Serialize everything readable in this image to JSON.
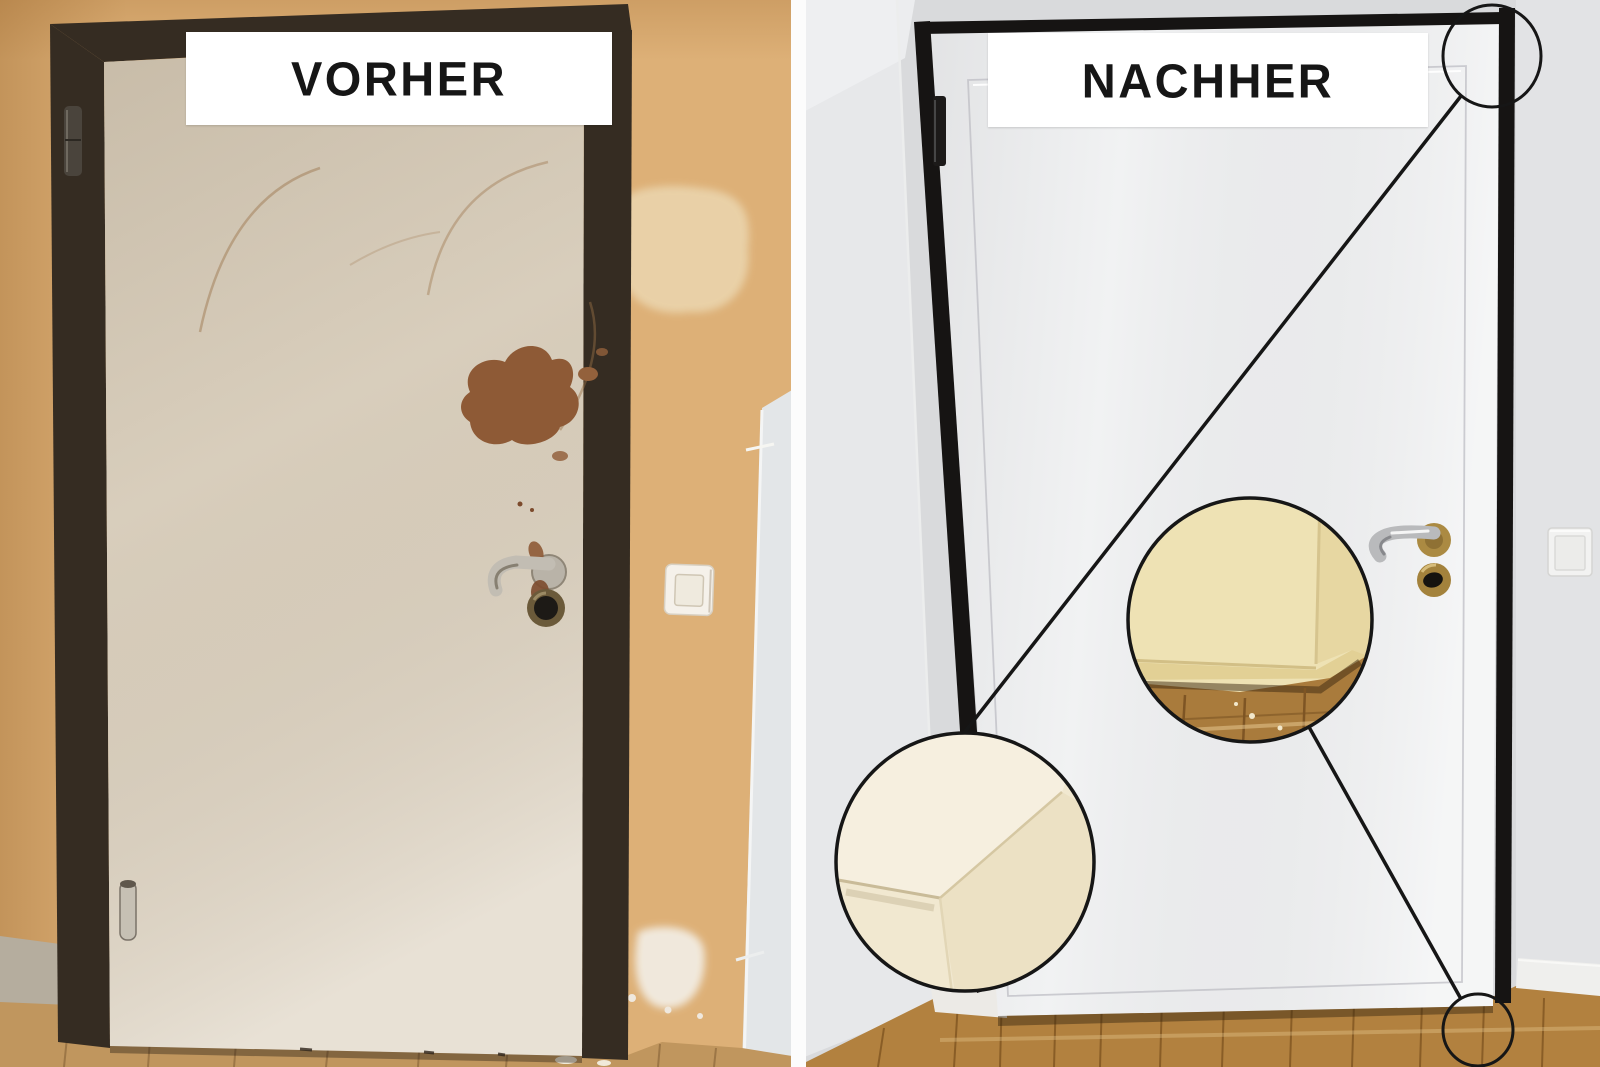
{
  "panels": {
    "before": {
      "label": "VORHER"
    },
    "after": {
      "label": "NACHHER"
    }
  },
  "colors": {
    "banner_bg": "#ffffff",
    "banner_text": "#161616",
    "divider": "#fcfcfc",
    "before_wall": "#ddb077",
    "before_frame": "#352c22",
    "before_door": "#ded4c3",
    "before_floor": "#c0965e",
    "before_baseboard": "#b5ad9e",
    "damage_brown": "#8e5a36",
    "adjacent_wall": "#e3e6e8",
    "after_wall": "#d9dadc",
    "after_wall_light": "#e7e8ea",
    "after_frame": "#161413",
    "after_door": "#f1f2f3",
    "after_floor": "#b2813f",
    "after_baseboard": "#efefed",
    "callout_cream": "#f1e8d0",
    "callout_cream_mid": "#eee2b4",
    "callout_wood": "#a97b3c",
    "annotation": "#161616",
    "handle_silver": "#b9babc",
    "handle_brass": "#ab8a42",
    "switch_face": "#f2f2f1"
  },
  "annotations": {
    "callouts": [
      {
        "name": "top-right-corner-marker",
        "shape": "circle-outline"
      },
      {
        "name": "top-corner-detail-zoom",
        "shape": "filled-photo-circle"
      },
      {
        "name": "bottom-corner-detail-zoom",
        "shape": "filled-photo-circle"
      },
      {
        "name": "bottom-right-corner-marker",
        "shape": "circle-outline"
      }
    ]
  }
}
